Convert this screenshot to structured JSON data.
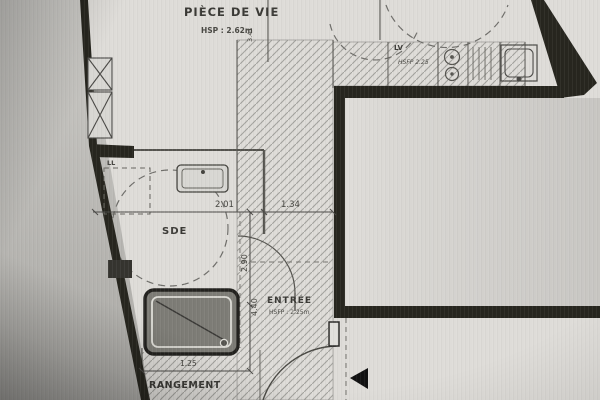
{
  "rooms": {
    "living": {
      "label": "PIÈCE DE VIE",
      "height_note": "HSP : 2.62m"
    },
    "bathroom": {
      "label": "SDE"
    },
    "entry": {
      "label": "ENTRÉE",
      "height_note": "HSFP : 2.25m"
    },
    "storage": {
      "label": "RANGEMENT"
    },
    "laundry": {
      "label": "LL"
    },
    "kitchen": {
      "dishwasher_label": "LV",
      "height_note": "HSFP 2.25"
    }
  },
  "dimensions": {
    "bathroom_width": "2.01",
    "hall_width": "1.34",
    "bathroom_length": "2.90",
    "hall_length": "4.40",
    "storage_width": "1.25",
    "living_width": "3.41"
  },
  "colors": {
    "paper": "#dedcd8",
    "wall": "#27261f",
    "line": "#4a4946",
    "hatch": "#a3a29e",
    "shower_fill": "#7d7c76"
  }
}
